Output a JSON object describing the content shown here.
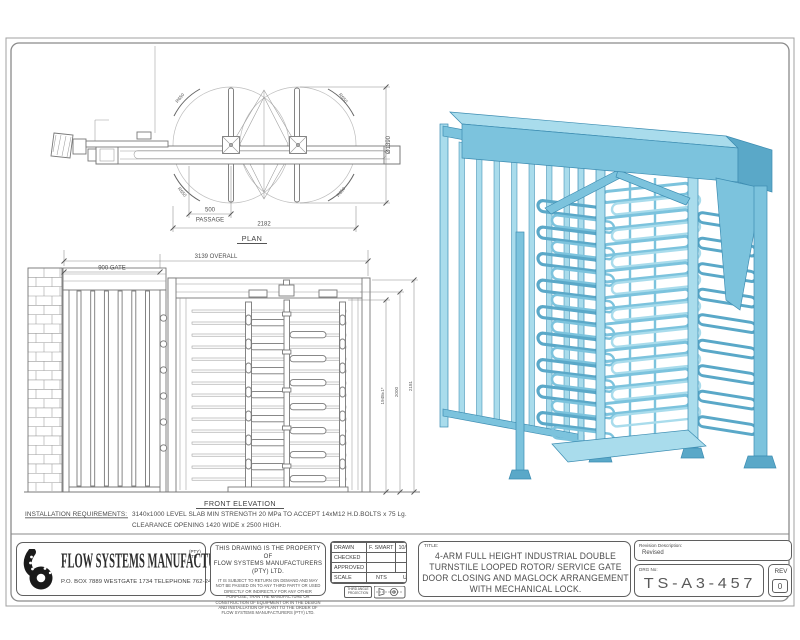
{
  "colors": {
    "model_light": "#a9dcec",
    "model_mid": "#7cc3dd",
    "model_shade": "#5aa8c8",
    "model_dark": "#3d8db2",
    "line": "#787878",
    "text": "#4a4a4a"
  },
  "plan": {
    "label": "PLAN",
    "dim_passage": "500",
    "dim_passage_sub": "PASSAGE",
    "dim_overall": "2182",
    "dim_diameter": "Ø1390",
    "radius_label": "R650"
  },
  "elevation": {
    "label": "FRONT ELEVATION",
    "dim_overall": "3139 OVERALL",
    "dim_gate": "900 GATE",
    "dim_height_rotor": "1948±1*",
    "dim_height_clear": "2000",
    "dim_height_overall": "2181"
  },
  "notes": {
    "label": "INSTALLATION REQUIREMENTS:",
    "line1": "3140x1000 LEVEL SLAB MIN STRENGTH 20 MPa TO ACCEPT 14xM12 H.D.BOLTS x 75 Lg.",
    "line2": "CLEARANCE OPENING 1420 WIDE x 2500 HIGH."
  },
  "title_block": {
    "company": {
      "name": "FLOW SYSTEMS MANUFACTURERS",
      "suffix_top": "(PTY)",
      "suffix_bottom": "LTD",
      "address": "P.O. BOX 7889 WESTGATE 1734 TELEPHONE 762-2453 FAX 762-2585"
    },
    "property_notice": {
      "head1": "THIS DRAWING IS THE PROPERTY OF",
      "head2": "FLOW SYSTEMS MANUFACTURERS (PTY) LTD.",
      "body": "IT IS SUBJECT TO RETURN ON DEMAND AND MAY NOT BE PASSED ON TO ANY THIRD PARTY OR USED DIRECTLY OR INDIRECTLY FOR ANY OTHER PURPOSE, THAN THE MANUFACTURE OR CONSTRUCTION OF EQUIPMENT OR IN THE DESIGN AND INSTALLATION OF PLANT TO THE ORDER OF FLOW SYSTEMS MANUFACTURERS (PTY) LTD."
    },
    "approval": {
      "drawn_label": "DRAWN",
      "drawn_by": "F. SMART",
      "drawn_date": "10/03/06",
      "checked_label": "CHECKED",
      "approved_label": "APPROVED",
      "scale_label": "SCALE",
      "scale_nts": "NTS",
      "scale_uos": "UOS",
      "projection_label": "THIRD ANGLE PROJECTION"
    },
    "title": {
      "label": "TITLE:",
      "lines": [
        "4-ARM FULL HEIGHT INDUSTRIAL DOUBLE",
        "TURNSTILE LOOPED ROTOR/ SERVICE GATE",
        "DOOR CLOSING AND MAGLOCK ARRANGEMENT",
        "WITH MECHANICAL LOCK."
      ]
    },
    "revision": {
      "label": "Revision Description:",
      "value": "Revised"
    },
    "drg": {
      "label": "DRG No:",
      "value": "TS-A3-457"
    },
    "rev": {
      "label": "REV",
      "value": "0"
    }
  }
}
